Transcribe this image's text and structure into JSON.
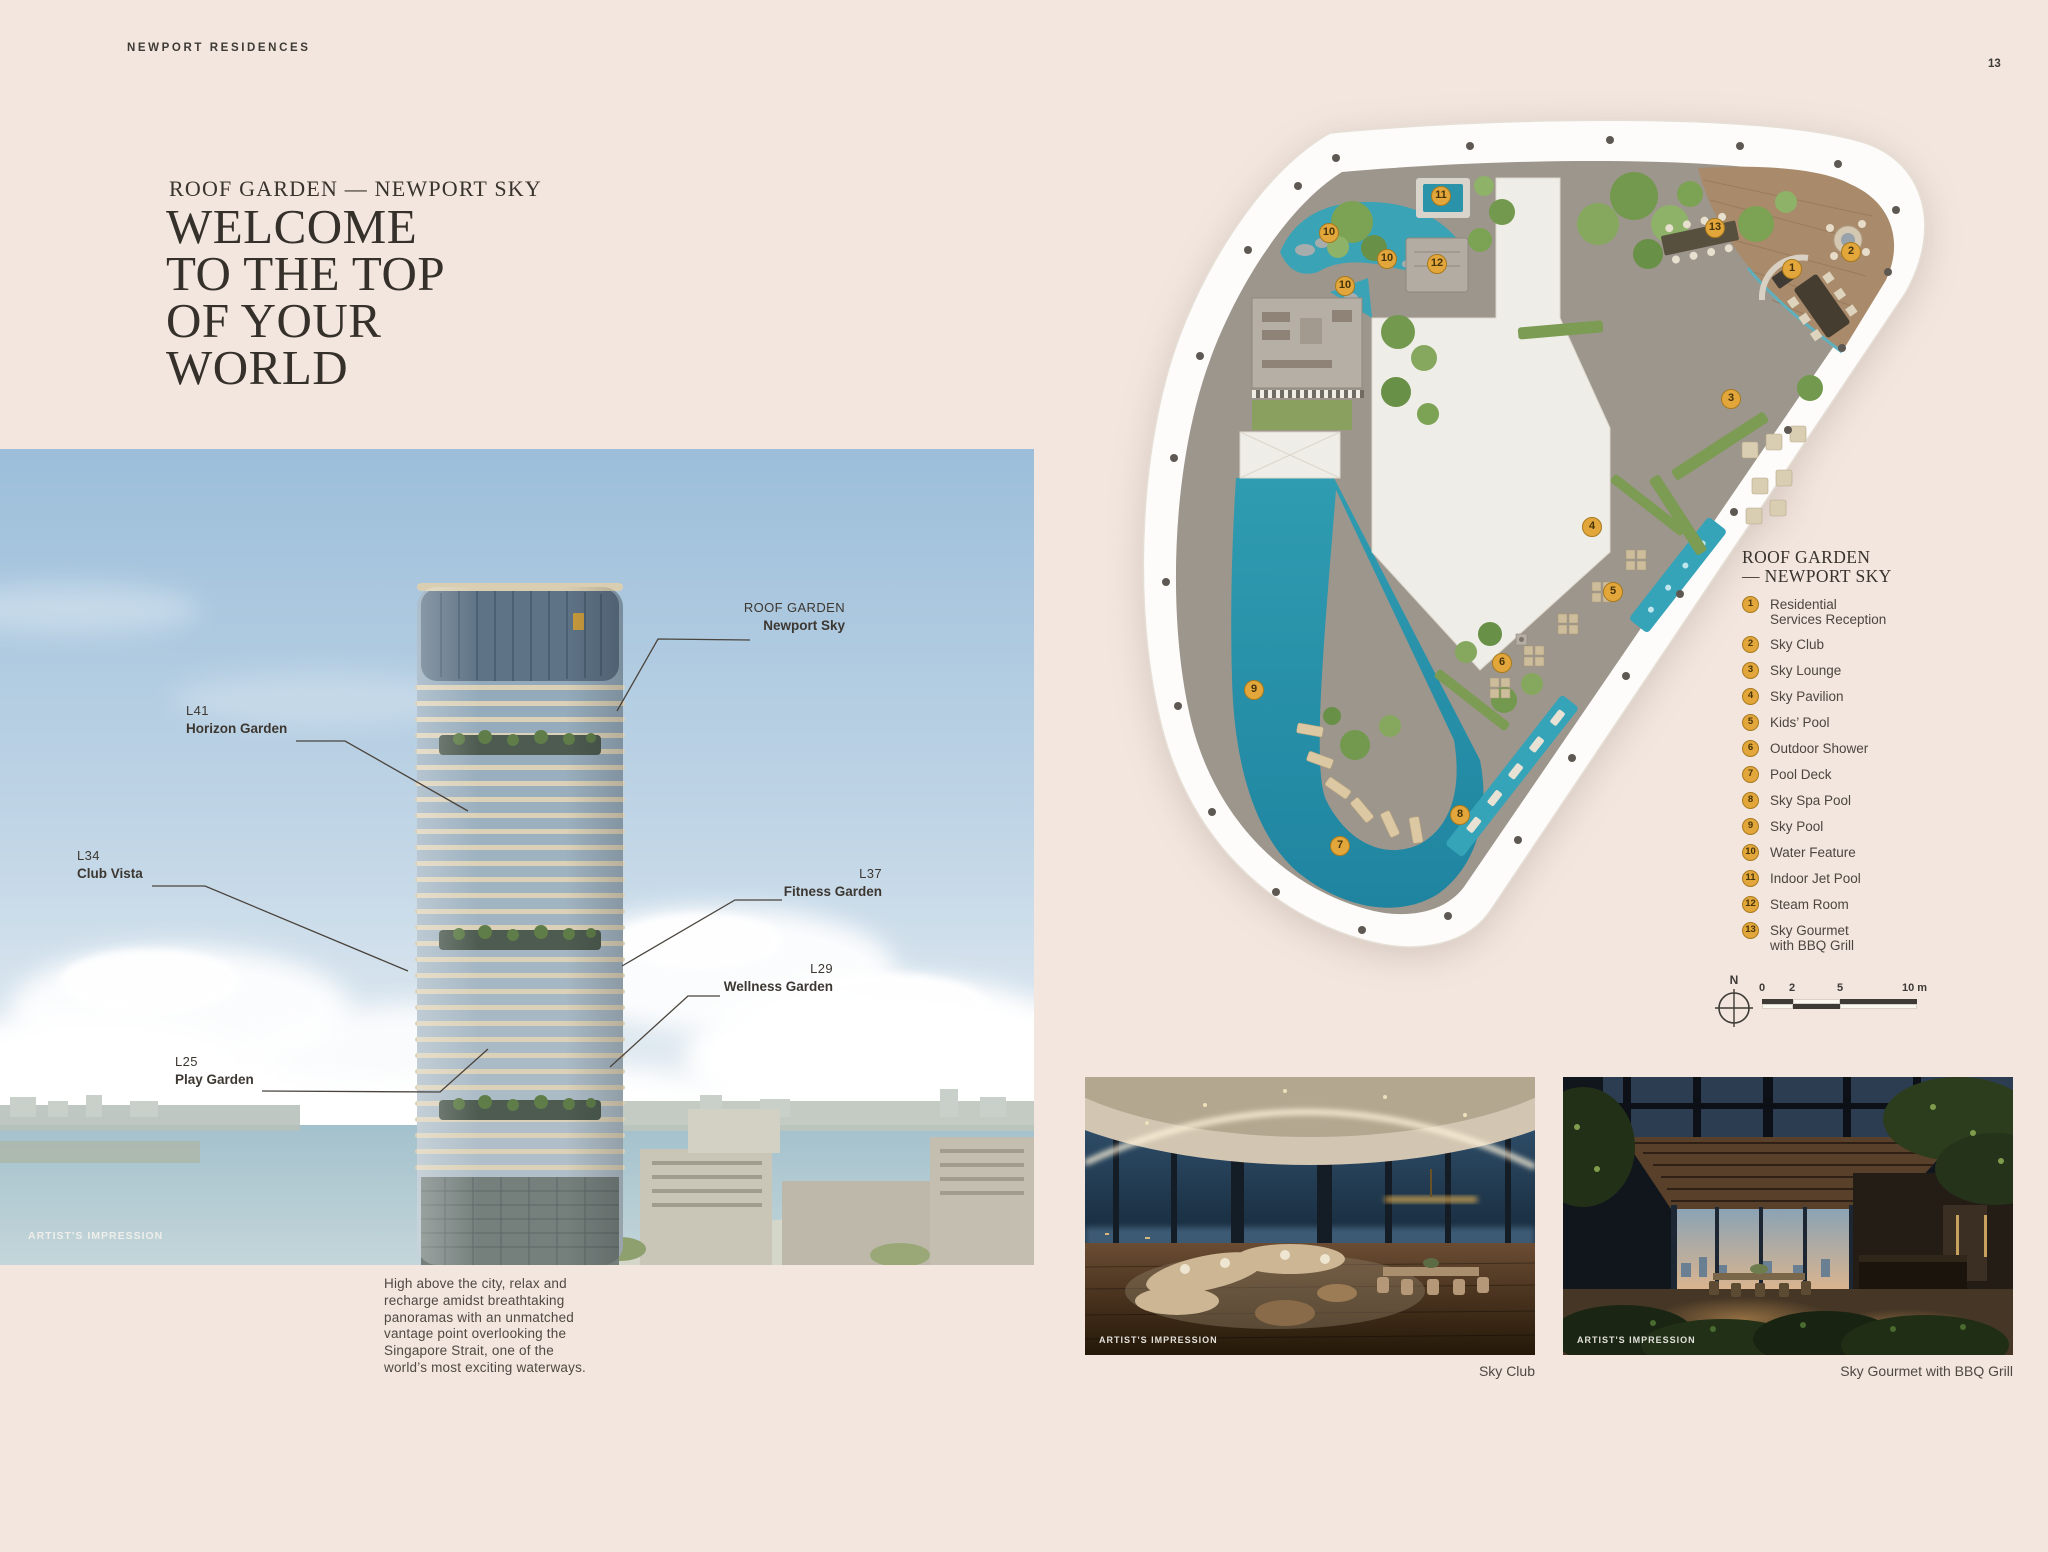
{
  "page": {
    "brand": "NEWPORT RESIDENCES",
    "page_number": "13"
  },
  "intro": {
    "eyebrow": "ROOF GARDEN — NEWPORT SKY",
    "title_lines": [
      "WELCOME",
      "TO THE TOP",
      "OF YOUR",
      "WORLD"
    ],
    "body": "High above the city, relax and recharge amidst breathtaking panoramas with an unmatched vantage point overlooking the Singapore Strait, one of the world’s most exciting waterways."
  },
  "tower_figure": {
    "artist_impression": "ARTIST'S IMPRESSION",
    "callouts": [
      {
        "level": "ROOF GARDEN",
        "name": "Newport Sky"
      },
      {
        "level": "L41",
        "name": "Horizon Garden"
      },
      {
        "level": "L37",
        "name": "Fitness Garden"
      },
      {
        "level": "L34",
        "name": "Club Vista"
      },
      {
        "level": "L29",
        "name": "Wellness Garden"
      },
      {
        "level": "L25",
        "name": "Play Garden"
      }
    ]
  },
  "plan": {
    "legend_title_line1": "ROOF GARDEN",
    "legend_title_line2": "— NEWPORT SKY",
    "legend": [
      {
        "num": "1",
        "label": "Residential\nServices Reception"
      },
      {
        "num": "2",
        "label": "Sky Club"
      },
      {
        "num": "3",
        "label": "Sky Lounge"
      },
      {
        "num": "4",
        "label": "Sky Pavilion"
      },
      {
        "num": "5",
        "label": "Kids’ Pool"
      },
      {
        "num": "6",
        "label": "Outdoor Shower"
      },
      {
        "num": "7",
        "label": "Pool Deck"
      },
      {
        "num": "8",
        "label": "Sky Spa Pool"
      },
      {
        "num": "9",
        "label": "Sky Pool"
      },
      {
        "num": "10",
        "label": "Water Feature"
      },
      {
        "num": "11",
        "label": "Indoor Jet Pool"
      },
      {
        "num": "12",
        "label": "Steam Room"
      },
      {
        "num": "13",
        "label": "Sky Gourmet\nwith BBQ Grill"
      }
    ],
    "markers": [
      "1",
      "2",
      "3",
      "4",
      "5",
      "6",
      "7",
      "8",
      "9",
      "10",
      "10",
      "10",
      "11",
      "12",
      "13"
    ],
    "compass": "N",
    "scale_ticks": [
      "0",
      "2",
      "5",
      "10 m"
    ]
  },
  "gallery": [
    {
      "caption": "Sky Club",
      "artist_impression": "ARTIST'S IMPRESSION"
    },
    {
      "caption": "Sky Gourmet with BBQ Grill",
      "artist_impression": "ARTIST'S IMPRESSION"
    }
  ]
}
